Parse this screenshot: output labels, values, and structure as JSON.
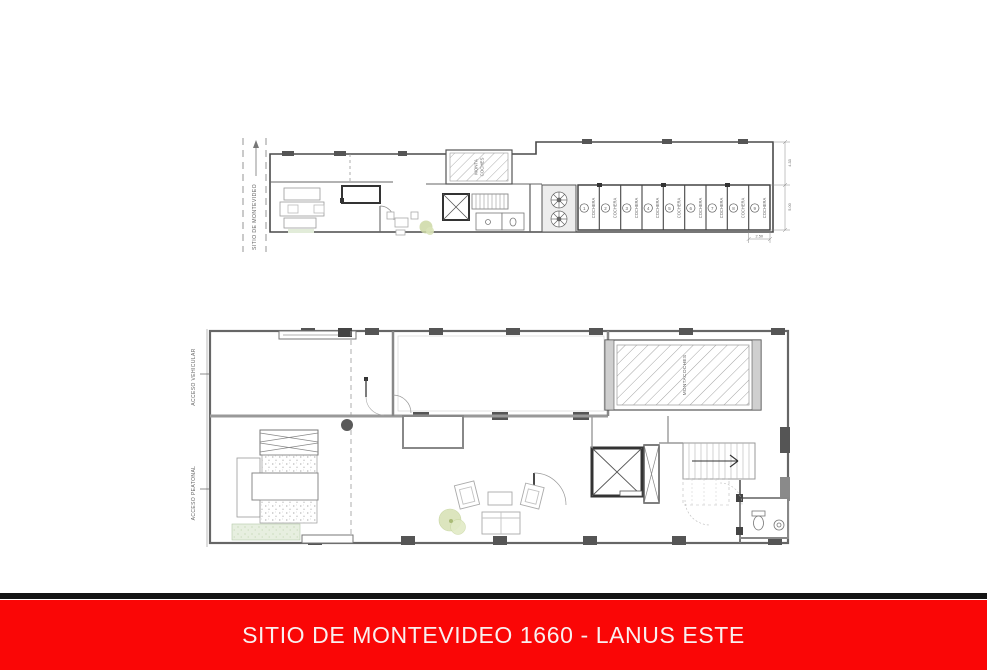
{
  "banner": {
    "title": "SITIO DE MONTEVIDEO 1660 - LANUS ESTE",
    "background_color": "#fa0606",
    "text_color": "#f9efef",
    "divider_color": "#141414"
  },
  "upper_plan": {
    "street_label": "SITIO DE MONTEVIDEO",
    "north_arrow_icon": "arrow-up",
    "car_lift": {
      "line1": "MONTA",
      "line2": "COCHES"
    },
    "fan_icon": "turbine-circle",
    "elevator_icon": "x-cross-shaft",
    "stalls": [
      {
        "label": "COCHERA",
        "number": "1"
      },
      {
        "label": "COCHERA",
        "number": "2"
      },
      {
        "label": "COCHERA",
        "number": "3"
      },
      {
        "label": "COCHERA",
        "number": "4"
      },
      {
        "label": "COCHERA",
        "number": "5"
      },
      {
        "label": "COCHERA",
        "number": "6"
      },
      {
        "label": "COCHERA",
        "number": "7"
      },
      {
        "label": "COCHERA",
        "number": "8"
      },
      {
        "label": "COCHERA",
        "number": "9"
      }
    ],
    "dimensions": {
      "right_upper": "4.33",
      "right_lower": "5.00",
      "bottom": "2.50"
    }
  },
  "lower_plan": {
    "vehicular_label": "ACCESO VEHICULAR",
    "vehicular_arrow_icon": "arrow-right",
    "pedestrian_label": "ACCESO PEATONAL",
    "pedestrian_arrow_icon": "arrow-right",
    "car_lift_label": "MONTACOCHES",
    "stair_arrow_icon": "arrow-right",
    "elevator_icon": "x-cross-shaft"
  },
  "colors": {
    "plan_line": "#666666",
    "wall_dark": "#444444",
    "pillar": "#555555",
    "hatch": "#9a9a9a",
    "plant_green": "#d9e3b8",
    "grass_green": "#e7efe0"
  }
}
